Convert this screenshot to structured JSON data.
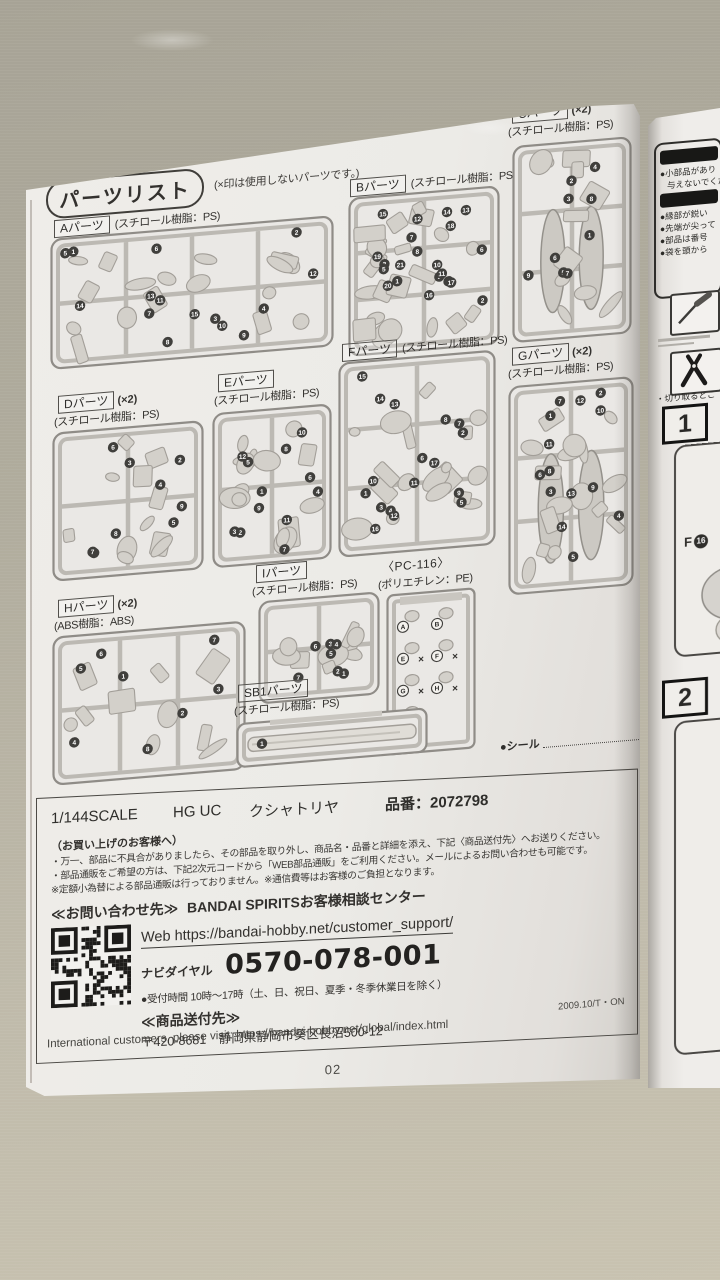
{
  "page": {
    "header": "パーツリスト",
    "note": "(×印は使用しないパーツです。)",
    "seal_label": "●シール",
    "seal_count": "1",
    "page_number": "02"
  },
  "runners": [
    {
      "id": "A",
      "label": "Aパーツ",
      "mult": "",
      "material": "(スチロール樹脂：PS)",
      "parts": 15
    },
    {
      "id": "B",
      "label": "Bパーツ",
      "mult": "",
      "material": "(スチロール樹脂：PS)",
      "parts": 21
    },
    {
      "id": "C",
      "label": "Cパーツ",
      "mult": "(×2)",
      "material": "(スチロール樹脂：PS)",
      "parts": 9
    },
    {
      "id": "D",
      "label": "Dパーツ",
      "mult": "(×2)",
      "material": "(スチロール樹脂：PS)",
      "parts": 9
    },
    {
      "id": "E",
      "label": "Eパーツ",
      "mult": "",
      "material": "(スチロール樹脂：PS)",
      "parts": 12
    },
    {
      "id": "F",
      "label": "Fパーツ",
      "mult": "",
      "material": "(スチロール樹脂：PS)",
      "parts": 17
    },
    {
      "id": "G",
      "label": "Gパーツ",
      "mult": "(×2)",
      "material": "(スチロール樹脂：PS)",
      "parts": 14
    },
    {
      "id": "H",
      "label": "Hパーツ",
      "mult": "(×2)",
      "material": "(ABS樹脂：ABS)",
      "parts": 8
    },
    {
      "id": "I",
      "label": "Iパーツ",
      "mult": "",
      "material": "(スチロール樹脂：PS)",
      "parts": 7
    },
    {
      "id": "PC",
      "label": "〈PC-116〉",
      "mult": "",
      "material": "(ポリエチレン：PE)",
      "parts": 7,
      "letters": [
        "A",
        "B",
        "E",
        "F",
        "G",
        "H",
        "J"
      ]
    },
    {
      "id": "SB1",
      "label": "SB1パーツ",
      "mult": "",
      "material": "(スチロール樹脂：PS)",
      "parts": 1
    }
  ],
  "info": {
    "scale": "1/144SCALE",
    "brand": "HG UC",
    "product": "クシャトリヤ",
    "item_no": "品番：2072798",
    "customer_heading": "（お買い上げのお客様へ）",
    "notes": [
      "・万一、部品に不具合がありましたら、その部品を取り外し、商品名・品番と詳細を添え、下記〈商品送付先〉へお送りください。",
      "・部品通販をご希望の方は、下記2次元コードから「WEB部品通販」をご利用ください。メールによるお問い合わせも可能です。",
      "※定額小為替による部品通販は行っておりません。※通信費等はお客様のご負担となります。"
    ],
    "contact_heading": "≪お問い合わせ先≫",
    "contact_name": "BANDAI SPIRITSお客様相談センター",
    "web": "Web https://bandai-hobby.net/customer_support/",
    "dial_label": "ナビダイヤル",
    "phone": "0570-078-001",
    "hours": "●受付時間 10時〜17時（土、日、祝日、夏季・冬季休業日を除く）",
    "ship_heading": "≪商品送付先≫",
    "address": "〒420-8681　静岡県静岡市葵区長沼500-12",
    "international": "International customers, please visit: https://bandai-hobby.net/global/index.html",
    "edition": "2009.10/T・ON"
  },
  "right_page": {
    "warn1a": "●小部品があり",
    "warn1b": "与えないでくだ",
    "warns": [
      "●縁部が鋭い",
      "●先端が尖って",
      "●部品は番号",
      "●袋を頭から"
    ],
    "cut_caption": "・切り取るとこ",
    "step1": "1",
    "step2": "2",
    "part_ref_letter": "F",
    "part_ref_number": "16"
  }
}
